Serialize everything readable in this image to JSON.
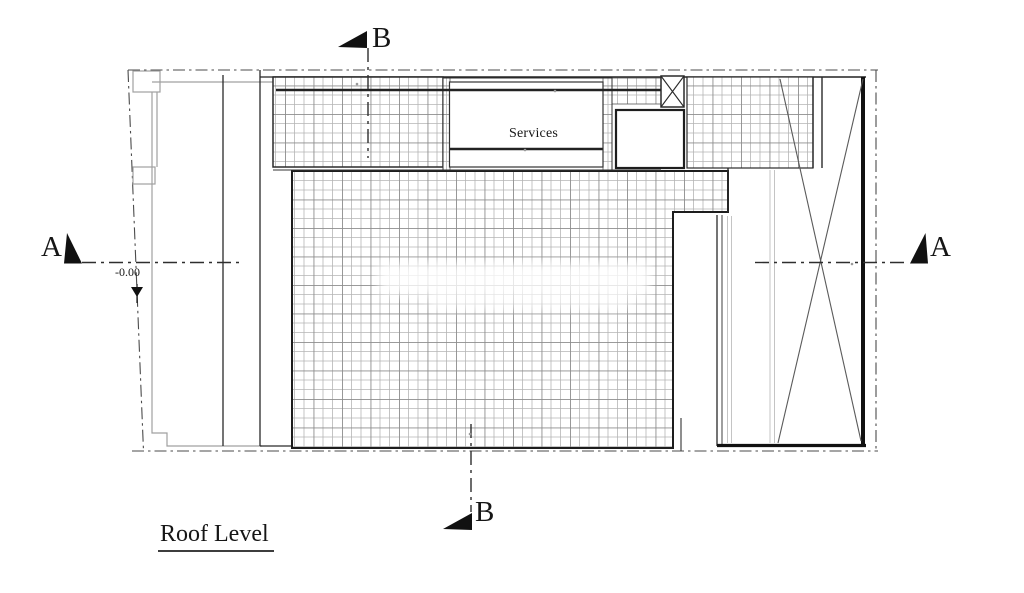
{
  "plan": {
    "title": "Roof Level",
    "rooms": {
      "services_label": "Services"
    },
    "levels": {
      "roof_datum": "-0.00"
    },
    "sections": {
      "a_label": "A",
      "b_label": "B"
    }
  },
  "colors": {
    "ink": "#1f1f1f",
    "hatch_minor": "#b5b5b5",
    "hatch_major": "#8d8d8d",
    "light_wall": "#a0a0a0",
    "paper": "#ffffff"
  }
}
